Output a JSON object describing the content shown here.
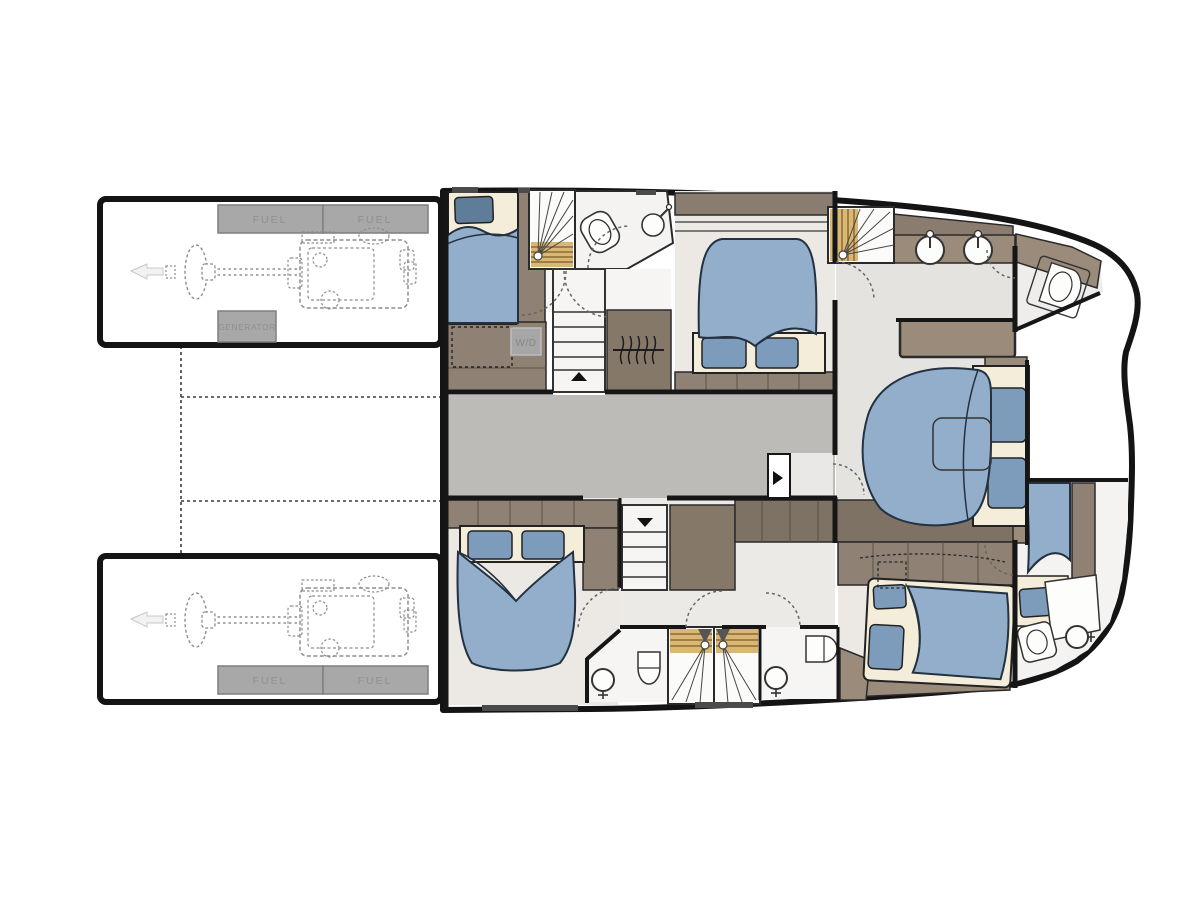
{
  "diagram": {
    "type": "catamaran-yacht-deck-floorplan",
    "labels": {
      "fuel": "FUEL",
      "generator": "GENERATOR",
      "washer_dryer": "W/D"
    },
    "colors": {
      "wall": "#161616",
      "hull_fill": "#ffffff",
      "floor_cabin": "#ece9e4",
      "floor_bathroom": "#f4f3f1",
      "floor_corridor": "#bcbbb8",
      "mattress_cream": "#f3edda",
      "bed_duvet_blue": "#92aecb",
      "pillow_blue": "#7d9cbc",
      "pillow_dark_blue": "#5f7d99",
      "cabinet_brown": "#8f8274",
      "cabinet_brown_dark": "#7e7264",
      "trim_brown": "#9a8b7b",
      "headboard_band": "#8a7c6e",
      "stair_wood": "#d9b877",
      "stair_wood_stripe": "#8d6b2f",
      "equipment_box_gray": "#a8a8a8",
      "engine_line_gray": "#8e8e8e",
      "door_arc": "#666666"
    }
  }
}
